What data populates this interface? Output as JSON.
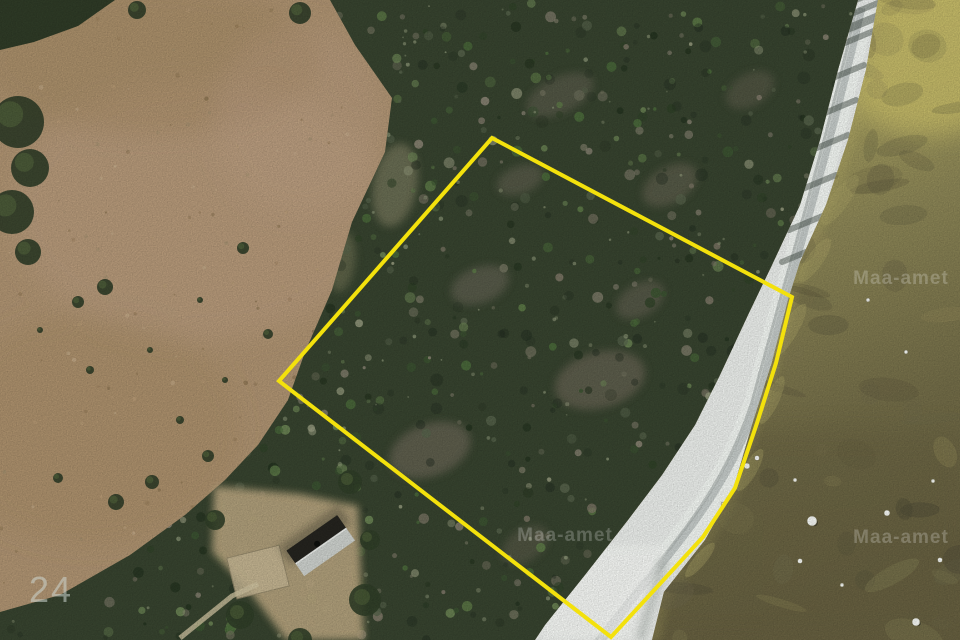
{
  "map": {
    "kind": "aerial-orthophoto-with-cadastral-overlay"
  },
  "overlay": {
    "parcel_boundary": {
      "color": "#f3e10c",
      "stroke_width": "4",
      "points": "492,138 792,297 776,363 757,423 735,488 703,537 611,637 279,381"
    }
  },
  "watermarks": {
    "brand_text": "Maa-amet",
    "instances": [
      {
        "x": "565",
        "y": "541"
      },
      {
        "x": "901",
        "y": "284"
      },
      {
        "x": "901",
        "y": "543"
      }
    ],
    "sheet_number": "24",
    "sheet_number_pos": {
      "x": "29",
      "y": "602"
    }
  },
  "scene": {
    "colors": {
      "marsh": "#ac9170",
      "marsh_light": "#bda088",
      "marsh_dark": "#9c8158",
      "forest_base": "#36422e",
      "beach": "#e7eae7",
      "beach_track": "#b9bfbd",
      "water_sand": "#c6bb68",
      "water_upper": "#a9a260",
      "water_mid": "#8a8455",
      "water_low": "#716b47",
      "water_deep": "#655e3f",
      "clearing": "#b2a07c",
      "house_roof_dark": "#24231e",
      "house_roof_light": "#c9cdc9",
      "rock": "#eff1ee"
    },
    "regions": {
      "forest": "M330,0 L858,0 L838,70 L820,140 L800,205 L772,265 L748,315 L720,375 L695,425 L662,475 L628,520 L585,575 L545,625 L535,640 L0,640 L0,612 L60,595 L130,555 L185,515 L225,480 L258,445 L288,400 L305,352 L332,290 L352,222 L385,152 L392,98 L355,45 Z",
      "beach": "M858,0 L878,0 L866,70 L848,140 L826,205 L800,262 L788,300 L772,362 L752,425 L733,490 L705,540 L664,592 L652,640 L535,640 L545,625 L585,575 L628,520 L662,475 L695,425 L720,375 L748,315 L772,265 L800,205 L820,140 L838,70 Z",
      "water": "M878,0 L960,0 L960,640 L652,640 L664,592 L705,540 L733,490 L752,425 L772,362 L788,300 L800,262 L826,205 L848,140 L866,70 Z",
      "corner_trees": "M0,0 L115,0 L78,26 L34,42 L0,50 Z",
      "clearing": "M214,486 L300,494 L358,506 L364,640 L286,640 L250,592 L212,552 Z"
    }
  }
}
